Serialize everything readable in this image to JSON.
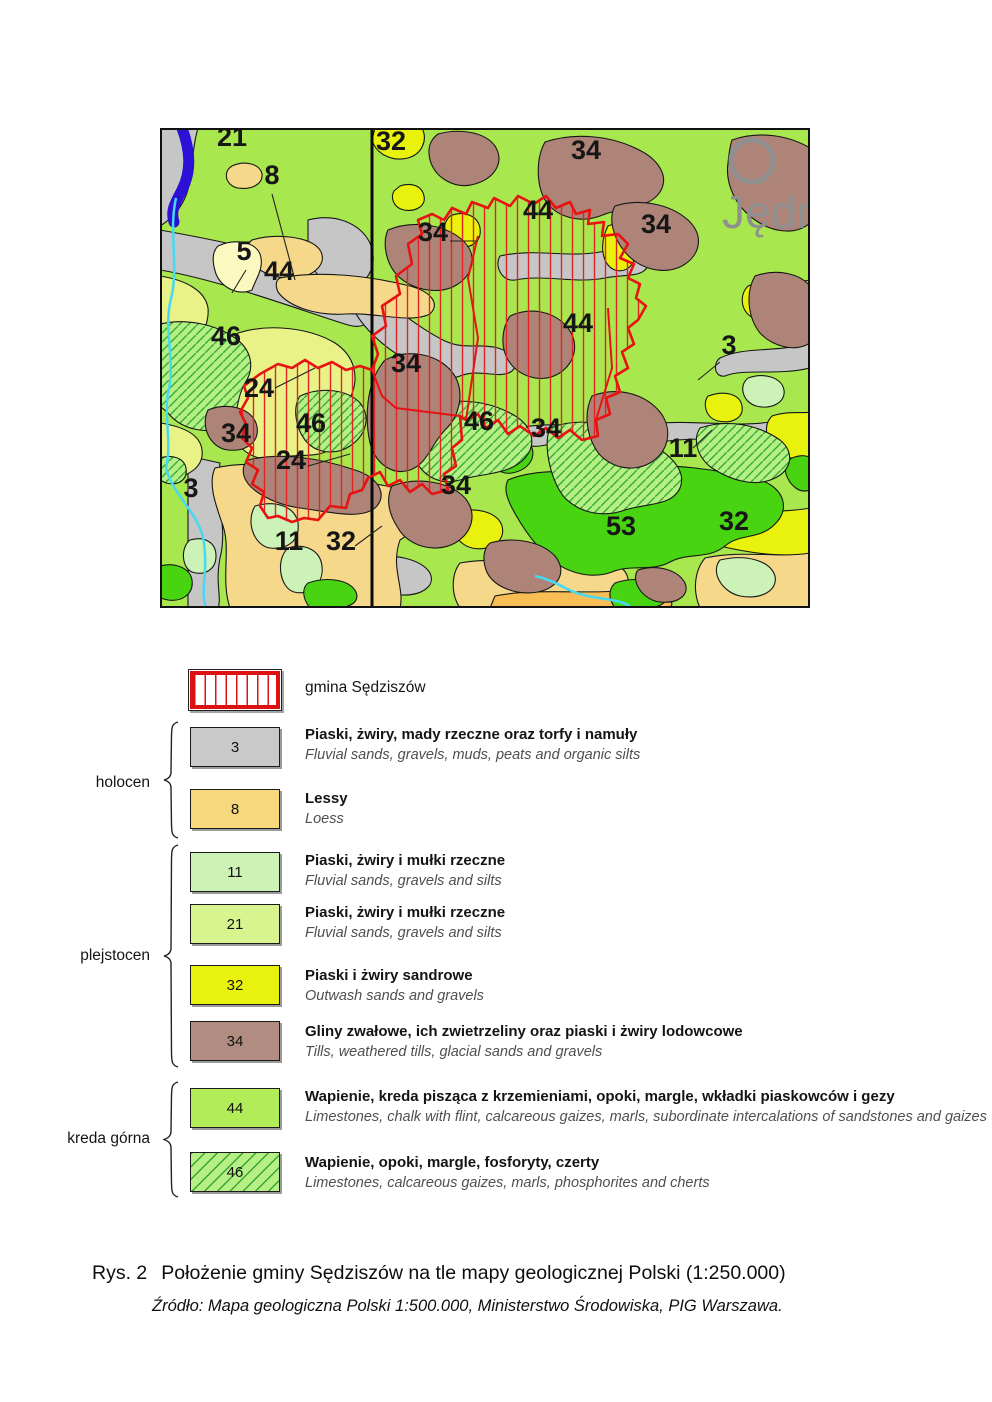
{
  "figure": {
    "caption_prefix": "Rys. 2",
    "caption_main": "Położenie gminy Sędziszów na tle mapy geologicznej Polski  (1:250.000)",
    "source": "Źródło: Mapa geologiczna Polski 1:500.000, Ministerstwo Środowiska, PIG Warszawa."
  },
  "map": {
    "city_label": "Jędrz",
    "colors": {
      "background_unit44": "#a9e74e",
      "gray_unit3": "#c6c6c6",
      "loess_unit8": "#f6d88b",
      "pale_yellow_unit24": "#e9f287",
      "cream_unit5": "#fbf8c0",
      "yellow_unit32": "#e9f20c",
      "mint_unit11": "#cdf2b7",
      "bright_green_unit53": "#49d411",
      "brown_unit34": "#ae8478",
      "hatched_unit46": "#b6f085",
      "river": "#2d10d5",
      "stream": "#45d9f2",
      "gmina_boundary": "#e81212",
      "city_marker": "#8f8f8f"
    },
    "labels": [
      {
        "t": "21",
        "x": 72,
        "y": 18
      },
      {
        "t": "8",
        "x": 112,
        "y": 56
      },
      {
        "t": "32",
        "x": 231,
        "y": 22
      },
      {
        "t": "34",
        "x": 426,
        "y": 31
      },
      {
        "t": "44",
        "x": 378,
        "y": 91
      },
      {
        "t": "34",
        "x": 273,
        "y": 113
      },
      {
        "t": "34",
        "x": 496,
        "y": 105
      },
      {
        "t": "5",
        "x": 84,
        "y": 132
      },
      {
        "t": "44",
        "x": 119,
        "y": 152
      },
      {
        "t": "46",
        "x": 66,
        "y": 217
      },
      {
        "t": "24",
        "x": 99,
        "y": 269
      },
      {
        "t": "34",
        "x": 246,
        "y": 244
      },
      {
        "t": "44",
        "x": 418,
        "y": 204
      },
      {
        "t": "3",
        "x": 569,
        "y": 226
      },
      {
        "t": "46",
        "x": 151,
        "y": 304
      },
      {
        "t": "46",
        "x": 319,
        "y": 302
      },
      {
        "t": "34",
        "x": 386,
        "y": 309
      },
      {
        "t": "11",
        "x": 523,
        "y": 329
      },
      {
        "t": "24",
        "x": 131,
        "y": 341
      },
      {
        "t": "34",
        "x": 76,
        "y": 314
      },
      {
        "t": "3",
        "x": 31,
        "y": 369
      },
      {
        "t": "34",
        "x": 296,
        "y": 366
      },
      {
        "t": "53",
        "x": 461,
        "y": 407
      },
      {
        "t": "32",
        "x": 574,
        "y": 402
      },
      {
        "t": "11",
        "x": 129,
        "y": 422
      },
      {
        "t": "32",
        "x": 181,
        "y": 422
      }
    ]
  },
  "legend": {
    "gmina": {
      "label": "gmina Sędziszów"
    },
    "groups": [
      {
        "name": "holocen"
      },
      {
        "name": "plejstocen"
      },
      {
        "name": "kreda górna"
      }
    ],
    "items": [
      {
        "code": "3",
        "color": "#c9c9c9",
        "pl": "Piaski, żwiry, mady rzeczne oraz torfy i namuły",
        "en": "Fluvial sands, gravels, muds, peats and organic silts"
      },
      {
        "code": "8",
        "color": "#f7d87c",
        "pl": "Lessy",
        "en": "Loess"
      },
      {
        "code": "11",
        "color": "#ccf2b5",
        "pl": "Piaski, żwiry i mułki rzeczne",
        "en": "Fluvial sands, gravels and silts"
      },
      {
        "code": "21",
        "color": "#d7f48f",
        "pl": "Piaski, żwiry i mułki rzeczne",
        "en": "Fluvial sands, gravels and silts"
      },
      {
        "code": "32",
        "color": "#e9f20c",
        "pl": "Piaski i żwiry sandrowe",
        "en": "Outwash sands and gravels"
      },
      {
        "code": "34",
        "color": "#b08d80",
        "pl": "Gliny zwałowe, ich zwietrzeliny oraz piaski i żwiry lodowcowe",
        "en": "Tills, weathered tills, glacial sands and gravels"
      },
      {
        "code": "44",
        "color": "#b2ec59",
        "pl": "Wapienie, kreda pisząca z krzemieniami, opoki, margle, wkładki piaskowców i gezy",
        "en": "Limestones, chalk with flint, calcareous gaizes, marls, subordinate intercalations of sandstones and gaizes"
      },
      {
        "code": "46",
        "color": "#b6f085",
        "hatched": true,
        "pl": "Wapienie, opoki, margle, fosforyty, czerty",
        "en": "Limestones, calcareous gaizes, marls, phosphorites and cherts"
      }
    ]
  }
}
